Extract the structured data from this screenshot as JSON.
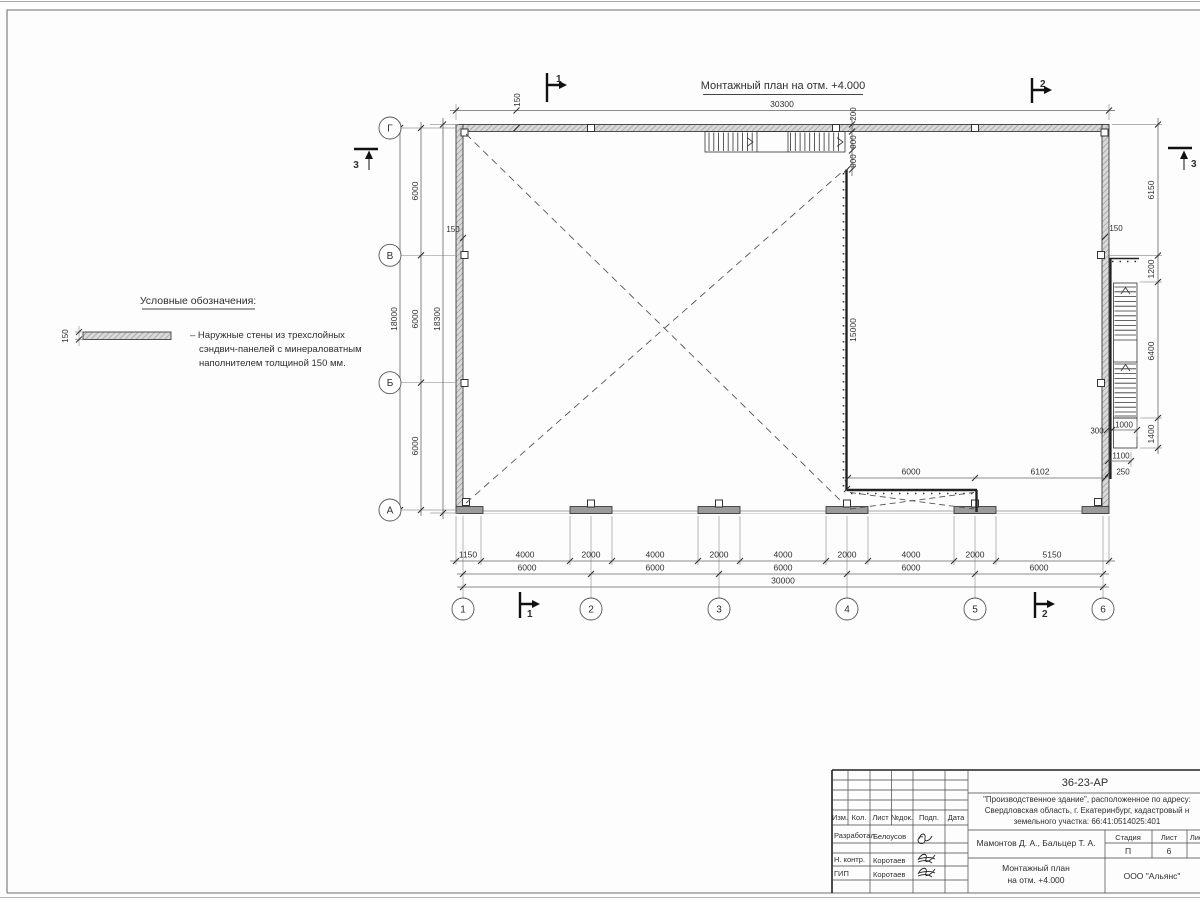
{
  "page": {
    "title": "Монтажный план на отм. +4.000"
  },
  "legend": {
    "header": "Условные обозначения:",
    "wall_thickness": "150",
    "item_line1": "– Наружные стены из трехслойных",
    "item_line2": "сэндвич-панелей с минераловатным",
    "item_line3": "наполнителем толщиной 150 мм."
  },
  "axes": {
    "h1": "1",
    "h2": "2",
    "h3": "3",
    "h4": "4",
    "h5": "5",
    "h6": "6",
    "vA": "А",
    "vB": "Б",
    "vV": "В",
    "vG": "Г"
  },
  "sections": {
    "s1": "1",
    "s2": "2",
    "s3": "3"
  },
  "dims": {
    "top_total": "30300",
    "top_wall": "150",
    "left_wall": "150",
    "right_wall": "150",
    "stair_offset": "200",
    "stair_flight1": "900",
    "stair_flight2": "900",
    "interior_wall": "15000",
    "left_bay1": "6000",
    "left_bay2": "6000",
    "left_bay3": "6000",
    "left_total": "18000",
    "left_outer": "18300",
    "right1": "6150",
    "right2": "1200",
    "right3": "6400",
    "right4": "1400",
    "rs300": "300",
    "rs1000": "1000",
    "rs1100": "1100",
    "rs250": "250",
    "inner1": "6000",
    "inner2": "6102",
    "b1": "1150",
    "b2": "4000",
    "b3": "2000",
    "b4": "4000",
    "b5": "2000",
    "b6": "4000",
    "b7": "2000",
    "b8": "4000",
    "b9": "2000",
    "b10": "5150",
    "s6000": "6000",
    "bottom_total": "30000"
  },
  "titleblock": {
    "doc_number": "36-23-АР",
    "project_line1": "\"Производственное здание\", расположенное по адресу:",
    "project_line2": "Свердловская область, г. Екатеринбург, кадастровый н",
    "project_line3": "земельного участка: 66:41:0514025:401",
    "col1": "Изм.",
    "col2": "Кол.",
    "col3": "Лист",
    "col4": "№док.",
    "col5": "Подп.",
    "col6": "Дата",
    "role1": "Разработал",
    "name1": "Белоусов",
    "role2": "Н. контр.",
    "name2": "Коротаев",
    "role3": "ГИП",
    "name3": "Коротаев",
    "authors": "Мамонтов Д. А., Бальцер Т. А.",
    "drawing_title_l1": "Монтажный план",
    "drawing_title_l2": "на отм. +4.000",
    "stage_label": "Стадия",
    "sheet_label": "Лист",
    "sheets_label": "Листов",
    "stage_value": "П",
    "sheet_value": "6",
    "company": "ООО \"Альянс\""
  }
}
